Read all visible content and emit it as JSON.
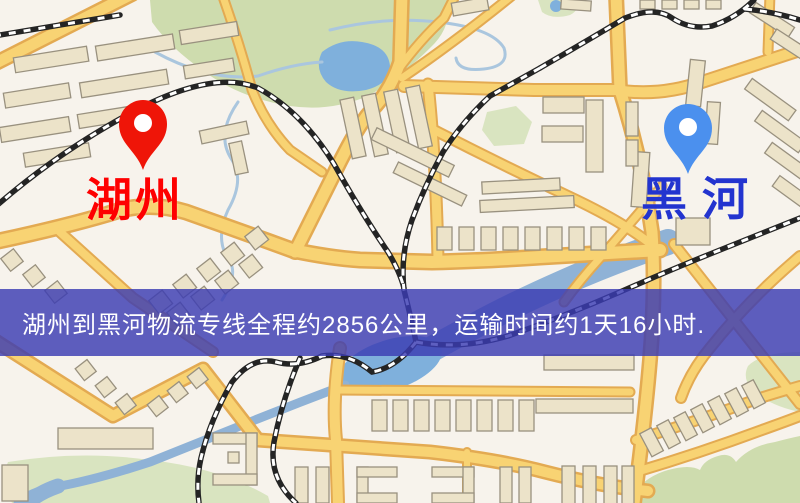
{
  "map": {
    "origin": {
      "label": "湖州",
      "pin_color": "#ef1508",
      "label_color": "#fe0000"
    },
    "destination": {
      "label": "黑河",
      "pin_color": "#4b90ee",
      "label_color": "#2334cf"
    },
    "banner": {
      "text": "湖州到黑河物流专线全程约2856公里，运输时间约1天16小时.",
      "bg_color": "rgba(58,60,178,0.82)",
      "text_color": "#ffffff"
    },
    "route": {
      "distance_km": "2856",
      "duration": "1天16小时"
    },
    "legend_colors": {
      "road_fill": "#f8d373",
      "road_casing": "#e3aa52",
      "water": "#7fb0dc",
      "park": "#cedcae",
      "building": "#ece3c9",
      "railway": "#242424"
    }
  }
}
